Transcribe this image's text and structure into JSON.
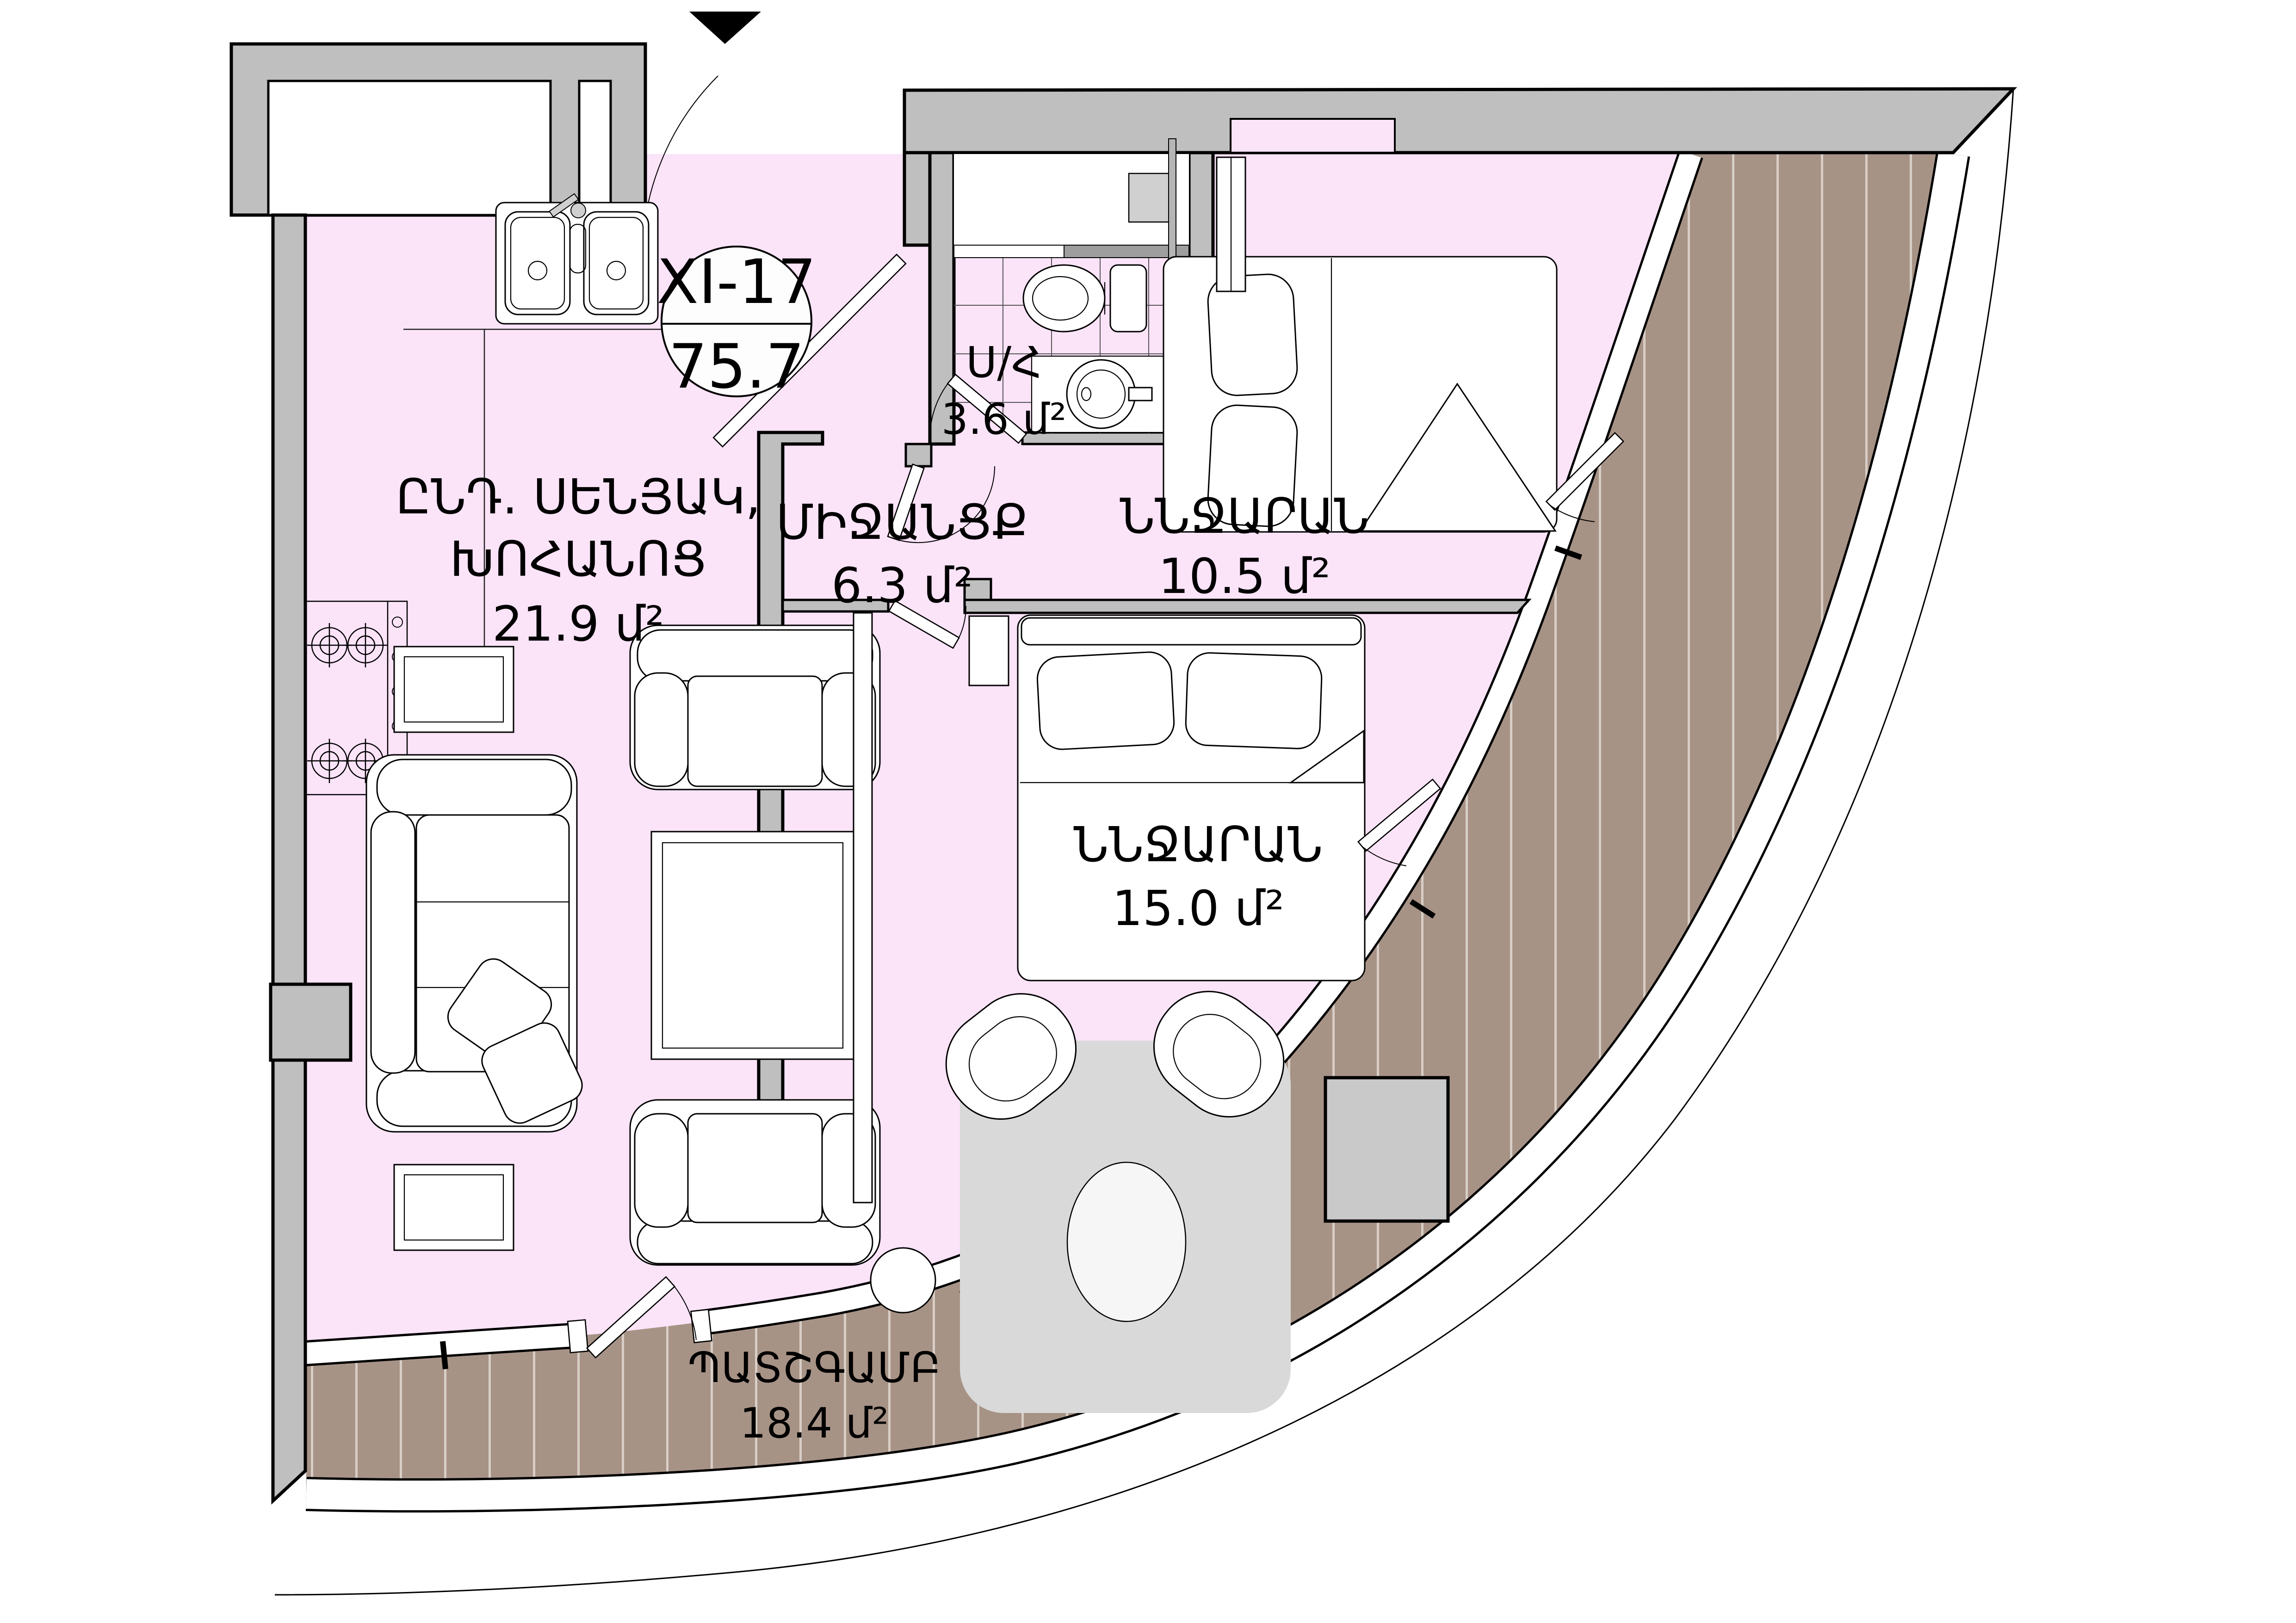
{
  "plan": {
    "type": "apartment-floor-plan",
    "entrance_marker": "triangle-down",
    "unit_badge": {
      "code": "XI-17",
      "area_total": "75.7"
    },
    "rooms": {
      "living_kitchen": {
        "label_line1": "ԸՆԴ. ՍԵՆՅԱԿ,",
        "label_line2": "ԽՈՀԱՆՈՑ",
        "area": "21.9 մ²"
      },
      "hallway": {
        "label": "ՄԻՋԱՆՑՔ",
        "area": "6.3 մ²"
      },
      "bathroom": {
        "label": "Ս/Հ",
        "area": "3.6 մ²"
      },
      "bedroom_small": {
        "label": "ՆՆՋԱՐԱՆ",
        "area": "10.5 մ²"
      },
      "bedroom_large": {
        "label": "ՆՆՋԱՐԱՆ",
        "area": "15.0 մ²"
      },
      "balcony": {
        "label": "ՊԱՏՇԳԱՄԲ",
        "area": "18.4 մ²"
      }
    },
    "colors": {
      "floor_pink": "#fbe3f8",
      "wall_gray": "#bfbfbf",
      "balcony_brown": "#a79386",
      "balcony_stripe": "#d8cec6",
      "furniture_gray": "#d9d9d9",
      "outline": "#000000"
    }
  }
}
